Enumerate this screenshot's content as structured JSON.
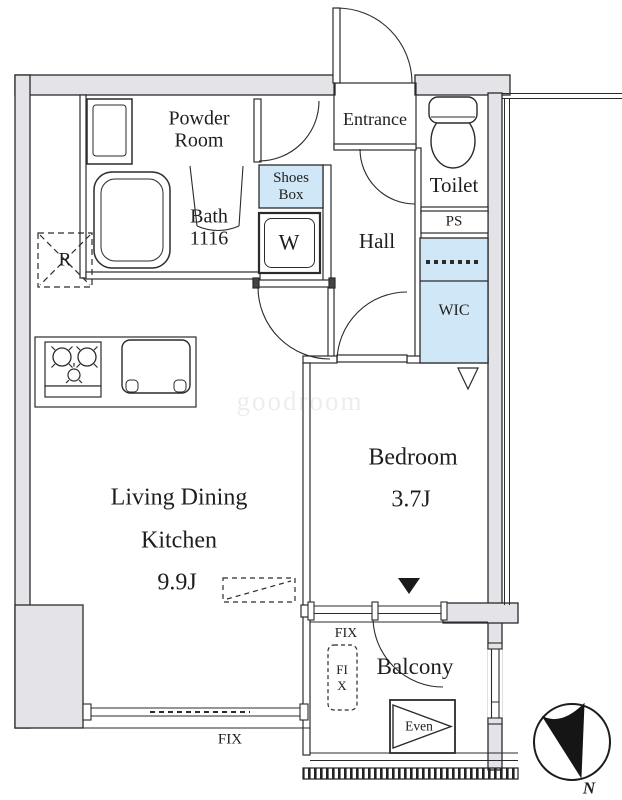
{
  "title": "Apartment floor plan 1LDK",
  "colors": {
    "wall_fill": "#e3e3e8",
    "line": "#2b2b2b",
    "storage_blue": "#cfe7f7",
    "needle_black": "#151515"
  },
  "rooms": {
    "powder_room": "Powder Room",
    "bath": "Bath 1116",
    "entrance": "Entrance",
    "toilet": "Toilet",
    "shoes_box": "Shoes Box",
    "washer": "W",
    "hall": "Hall",
    "pipe_space": "PS",
    "walk_in_closet": "WIC",
    "refrigerator": "R",
    "bedroom_name": "Bedroom",
    "bedroom_size": "3.7J",
    "ldk_line1": "Living Dining",
    "ldk_line2": "Kitchen",
    "ldk_size": "9.9J",
    "balcony": "Balcony"
  },
  "annotations": {
    "fix_main": "FIX",
    "fix_balcony": "FIX",
    "fix_balcony_vertical": "FIX",
    "evacuation_hatch": "Even",
    "compass_north": "N",
    "watermark": "goodroom"
  },
  "icons": {
    "bathtub-icon": "bathtub outline",
    "toilet-icon": "toilet tank and bowl",
    "vanity-sink-icon": "powder room sink",
    "stove-icon": "3-burner stove",
    "kitchen-sink-icon": "kitchen sink",
    "refrigerator-symbol": "dashed square with cross",
    "washer-space-icon": "washing machine space",
    "door-arc": "door swing arc",
    "window-double-line": "window",
    "hatch-band": "balcony edge hatching",
    "evacuation-hatch-icon": "triangle in box",
    "north-arrow-icon": "compass needle"
  }
}
